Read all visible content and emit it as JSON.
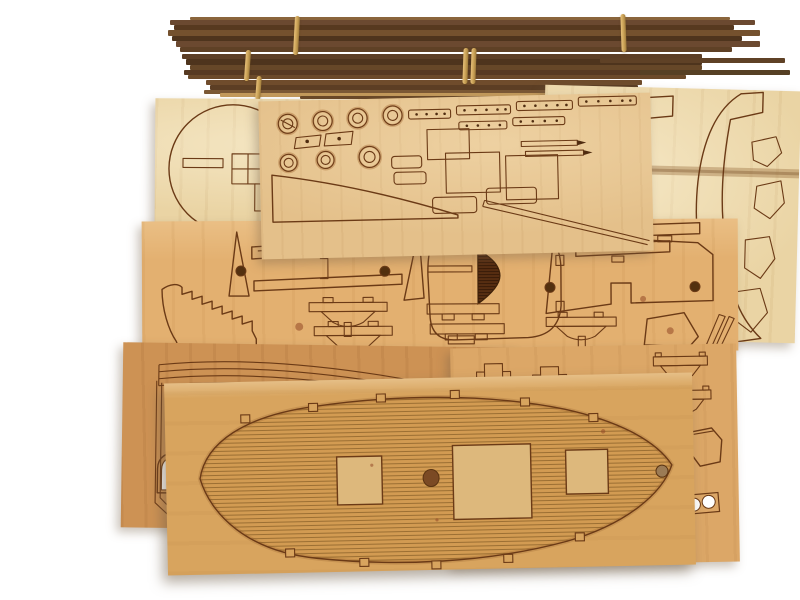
{
  "scene": {
    "description": "Wooden model ship kit: three rubber-banded bundles of dark walnut strips above seven overlapping laser-cut plywood sheets with hull frames, portholes, gratings, arched ports and a planked deck piece with hatch cutouts.",
    "strip_bundles": {
      "count": 3,
      "rubber_bands": 5,
      "material": "walnut strips"
    },
    "sheets": [
      {
        "id": "sheet-upper-left",
        "material": "pale birch ply",
        "parts": "round bow former with slots"
      },
      {
        "id": "sheet-upper-right",
        "material": "pale birch ply",
        "parts": "curved hull side profiles, small brackets"
      },
      {
        "id": "sheet-upper-middle",
        "material": "light tan ply",
        "parts": "7 porthole rings, chainplate strips, 3 gratings, planked stern triangle"
      },
      {
        "id": "sheet-middle",
        "material": "tan ply",
        "parts": "toothed stem, keel frames, transom with hatched window, mast-step brackets"
      },
      {
        "id": "sheet-lower-left",
        "material": "dark tan ply",
        "parts": "curved wales, three arched gunports (one cut through)"
      },
      {
        "id": "sheet-lower-right",
        "material": "tan ply",
        "parts": "stepped ladders, knee brackets, two-hole chainplate"
      },
      {
        "id": "deck-sheet",
        "material": "tan ply",
        "parts": "planked deck oval, 3 hatch openings, 2 mast holes, edge tabs"
      }
    ],
    "deck": {
      "hatches": 3,
      "mast_holes": 2,
      "edge_tabs_top": 6,
      "edge_tabs_bottom": 5,
      "planked": true
    }
  },
  "palette": {
    "bg": "#ffffff",
    "line": "#6b3a16",
    "scorch": "#9a5c26",
    "sheet_pale": "#ead4a4",
    "sheet_b": "#e4c08a",
    "sheet_d": "#e3b070",
    "sheet_e": "#cd9254",
    "sheet_f": "#dca767",
    "sheet_g": "#d8a45e",
    "deck_field": "#d29b52",
    "deck_hatch": "#ddb87c",
    "band": "#c9a155",
    "strip_dark1": "#6b4930",
    "strip_dark2": "#57391f",
    "strip_dark3": "#74512e",
    "strip_dark4": "#4e341d",
    "strip_tan": "#c39a5c"
  }
}
